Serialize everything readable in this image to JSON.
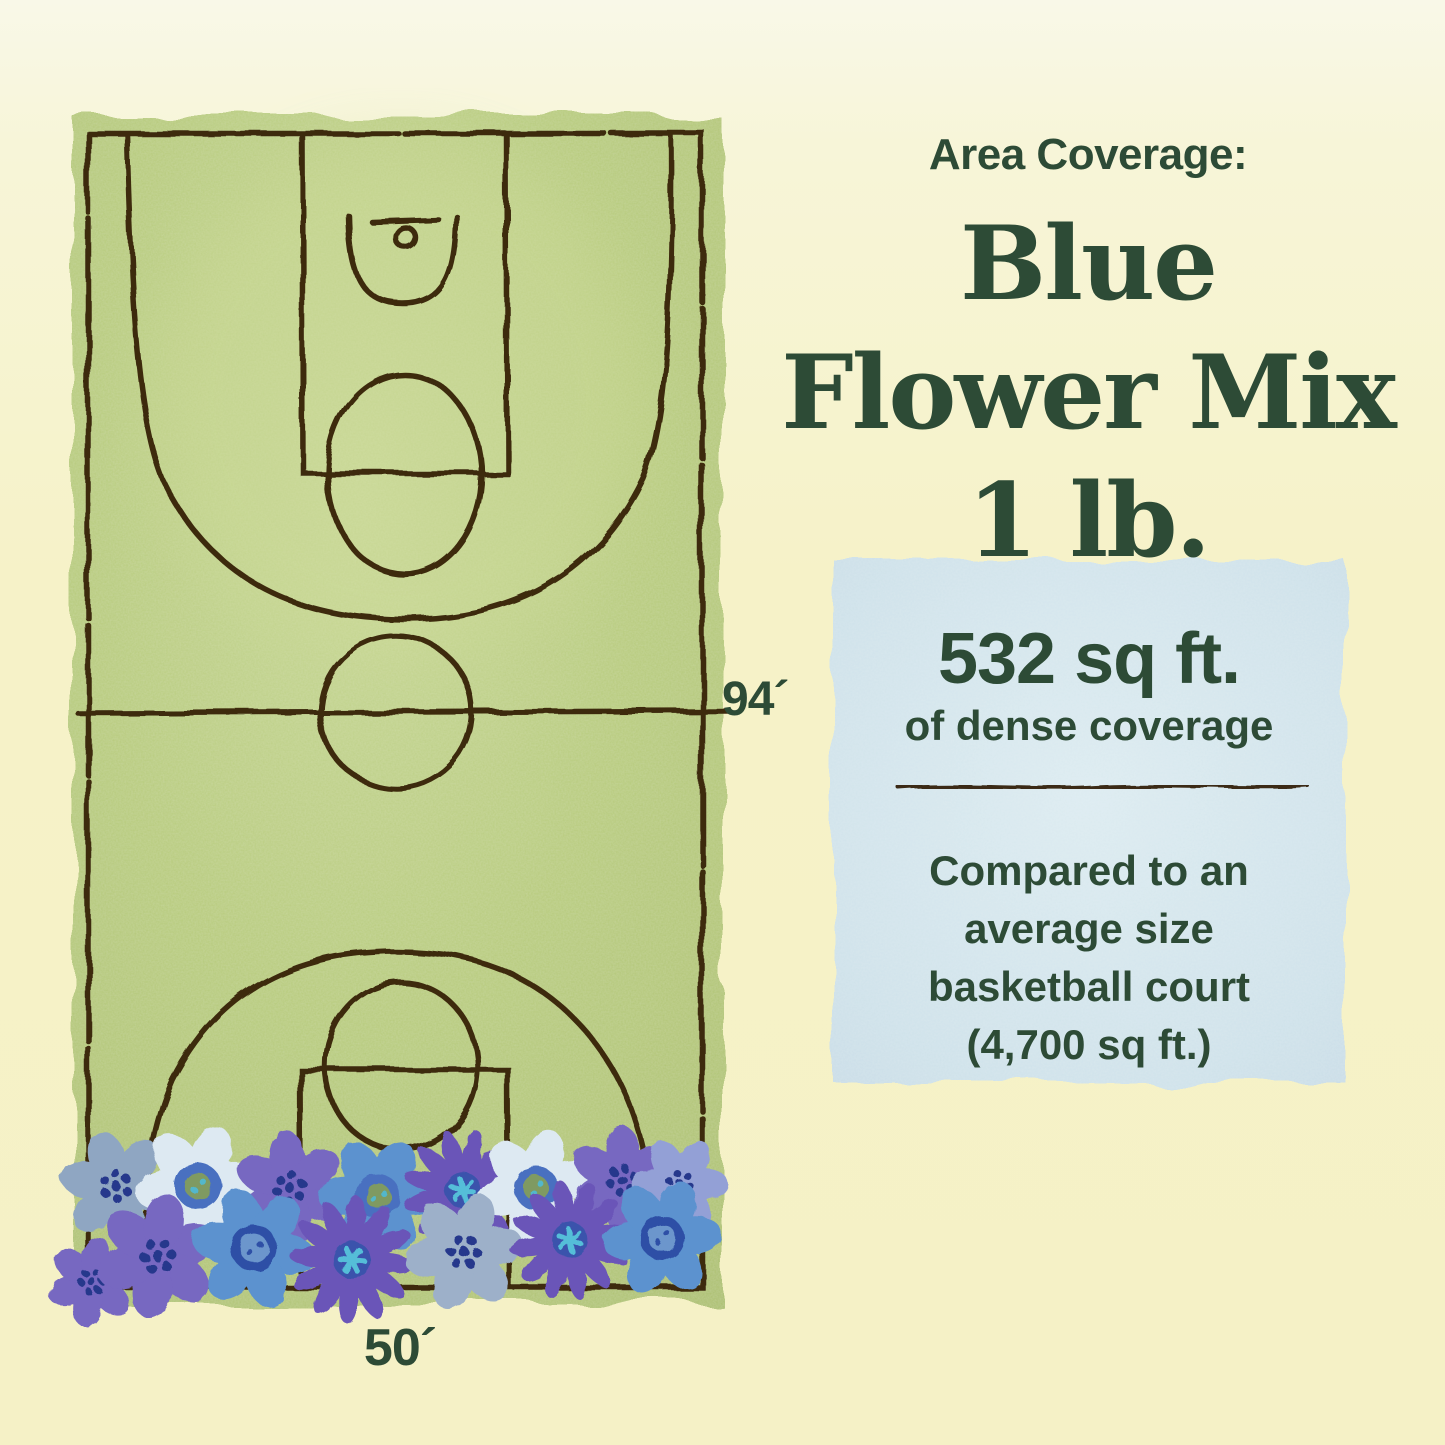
{
  "header": {
    "kicker": "Area Coverage:",
    "title_lines": [
      "Blue",
      "Flower Mix",
      "1 lb."
    ]
  },
  "court": {
    "length_label": "94´",
    "width_label": "50´"
  },
  "coverage": {
    "amount": "532 sq ft.",
    "amount_caption": "of dense coverage",
    "comparison_lines": [
      "Compared to an",
      "average size",
      "basketball court",
      "(4,700 sq ft.)"
    ]
  },
  "colors": {
    "text_green": "#2d4b36",
    "court_green": "#b5c97b",
    "line_brown": "#3e2c10",
    "box_blue": "#cfe2ea",
    "background_yellow": "#f6f2c8"
  }
}
